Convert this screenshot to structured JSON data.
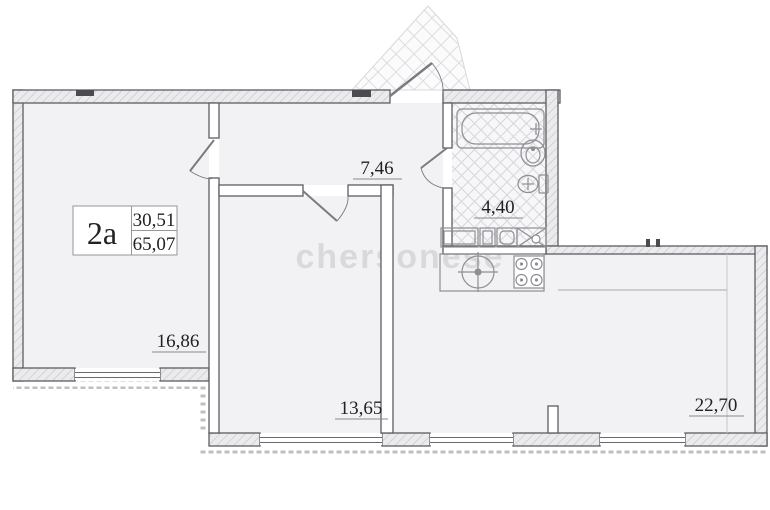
{
  "plan": {
    "unit": {
      "name": "2a",
      "living_area": "30,51",
      "total_area": "65,07"
    },
    "rooms": [
      {
        "id": "bedroom-1",
        "area": "16,86"
      },
      {
        "id": "hallway",
        "area": "7,46"
      },
      {
        "id": "bathroom",
        "area": "4,40"
      },
      {
        "id": "bedroom-2",
        "area": "13,65"
      },
      {
        "id": "kitchen-living-room",
        "area": "22,70"
      }
    ],
    "watermark": "chersonese",
    "colors": {
      "wall_line": "#5d5d62",
      "floor": "#f2f2f4",
      "fixture_line": "#8e8e94",
      "label_text": "#222226",
      "watermark": "#d9d9db"
    }
  }
}
